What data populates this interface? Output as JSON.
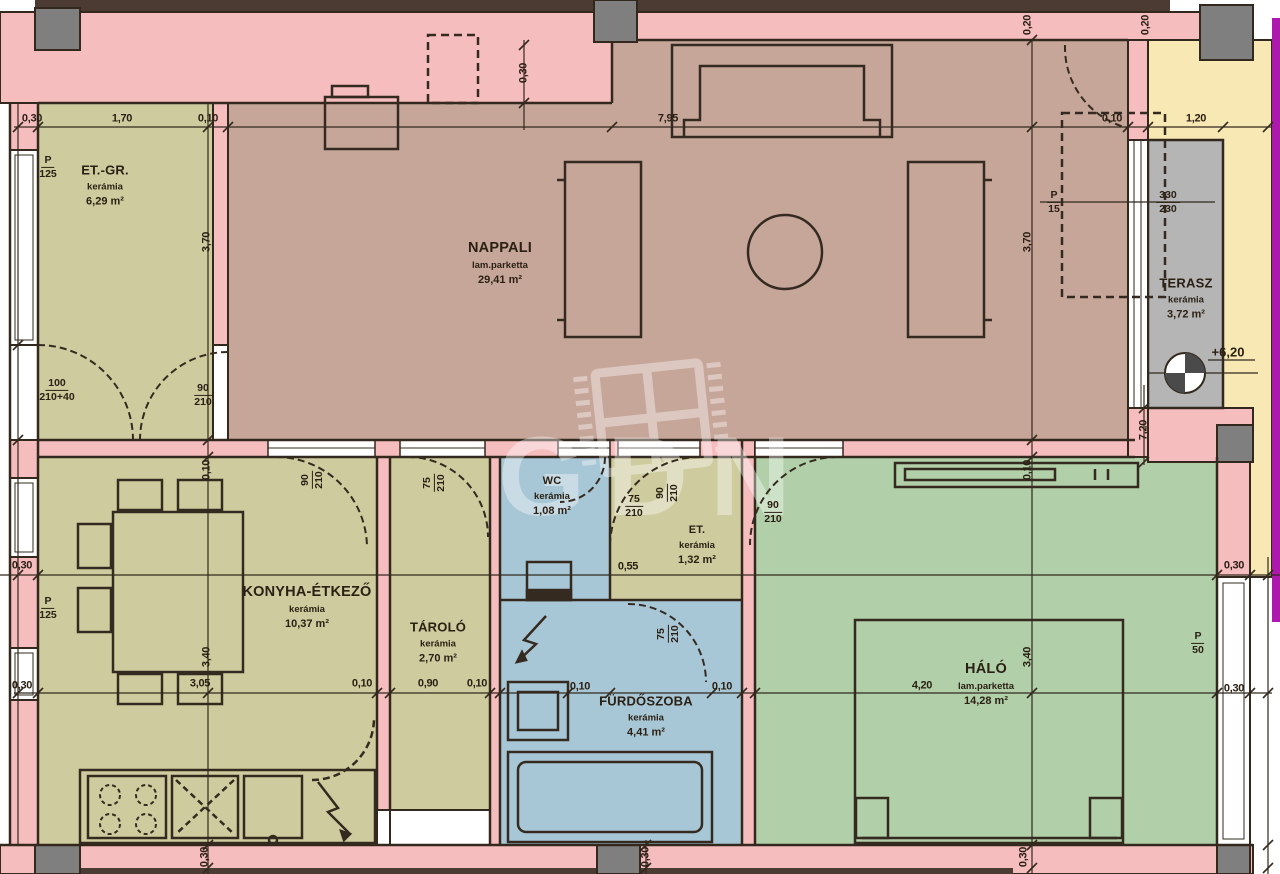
{
  "watermark": {
    "text": "GDN"
  },
  "palette": {
    "wall_pink": "#f6bdbf",
    "room_olive": "#cecc9e",
    "room_living": "#c7a69a",
    "room_blue": "#a8c7d6",
    "room_green": "#b1d0a9",
    "terrace_gray": "#b5b5b5",
    "surround_cream": "#f8e9b4",
    "pillar_gray": "#7f7f7f",
    "line_dark": "#2f261b",
    "edge_purple": "#ac19ac"
  },
  "rooms": [
    {
      "id": "et-gr",
      "name": "ET.-GR.",
      "material": "kerámia",
      "area": "6,29 m²"
    },
    {
      "id": "nappali",
      "name": "NAPPALI",
      "material": "lam.parketta",
      "area": "29,41 m²"
    },
    {
      "id": "terasz",
      "name": "TERASZ",
      "material": "kerámia",
      "area": "3,72 m²"
    },
    {
      "id": "konyha",
      "name": "KONYHA-ÉTKEZŐ",
      "material": "kerámia",
      "area": "10,37 m²"
    },
    {
      "id": "tarolo",
      "name": "TÁROLÓ",
      "material": "kerámia",
      "area": "2,70 m²"
    },
    {
      "id": "wc",
      "name": "WC",
      "material": "kerámia",
      "area": "1,08 m²"
    },
    {
      "id": "et",
      "name": "ET.",
      "material": "kerámia",
      "area": "1,32 m²"
    },
    {
      "id": "furdoszoba",
      "name": "FÜRDŐSZOBA",
      "material": "kerámia",
      "area": "4,41 m²"
    },
    {
      "id": "halo",
      "name": "HÁLÓ",
      "material": "lam.parketta",
      "area": "14,28 m²"
    }
  ],
  "elevation_label": "+6,20",
  "dim_labels": [
    {
      "text": "0,30",
      "x": 32,
      "y": 119
    },
    {
      "text": "1,70",
      "x": 122,
      "y": 119
    },
    {
      "text": "0,10",
      "x": 208,
      "y": 119
    },
    {
      "text": "7,95",
      "x": 668,
      "y": 119
    },
    {
      "text": "0,10",
      "x": 1112,
      "y": 119
    },
    {
      "text": "1,20",
      "x": 1196,
      "y": 119
    },
    {
      "text": "0,30",
      "x": 524,
      "y": 73,
      "rot": true
    },
    {
      "text": "0,20",
      "x": 1028,
      "y": 25,
      "rot": true
    },
    {
      "text": "0,20",
      "x": 1146,
      "y": 25,
      "rot": true
    },
    {
      "text": "3,70",
      "x": 207,
      "y": 242,
      "rot": true
    },
    {
      "text": "0,10",
      "x": 207,
      "y": 470,
      "rot": true
    },
    {
      "text": "3,40",
      "x": 207,
      "y": 657,
      "rot": true
    },
    {
      "text": "0,30",
      "x": 205,
      "y": 857,
      "rot": true
    },
    {
      "text": "3,70",
      "x": 1028,
      "y": 242,
      "rot": true
    },
    {
      "text": "0,10",
      "x": 1028,
      "y": 470,
      "rot": true
    },
    {
      "text": "3,40",
      "x": 1028,
      "y": 657,
      "rot": true
    },
    {
      "text": "0,30",
      "x": 1024,
      "y": 857,
      "rot": true
    },
    {
      "text": "0,30",
      "x": 646,
      "y": 857,
      "rot": true
    },
    {
      "text": "7,20",
      "x": 1144,
      "y": 430,
      "rot": true
    },
    {
      "text": "0,30",
      "x": 22,
      "y": 566
    },
    {
      "text": "0,30",
      "x": 1234,
      "y": 566
    },
    {
      "text": "0,30",
      "x": 22,
      "y": 686
    },
    {
      "text": "3,05",
      "x": 200,
      "y": 684
    },
    {
      "text": "0,10",
      "x": 362,
      "y": 684
    },
    {
      "text": "0,90",
      "x": 428,
      "y": 684
    },
    {
      "text": "0,10",
      "x": 477,
      "y": 684
    },
    {
      "text": "0,10",
      "x": 580,
      "y": 687
    },
    {
      "text": "0,10",
      "x": 722,
      "y": 687
    },
    {
      "text": "4,20",
      "x": 922,
      "y": 686
    },
    {
      "text": "0,30",
      "x": 1234,
      "y": 689
    },
    {
      "text": "0,55",
      "x": 628,
      "y": 567
    }
  ],
  "fractions": [
    {
      "top": "P",
      "bottom": "125",
      "x": 48,
      "y": 167
    },
    {
      "top": "P",
      "bottom": "125",
      "x": 48,
      "y": 608
    },
    {
      "top": "P",
      "bottom": "50",
      "x": 1198,
      "y": 643
    },
    {
      "top": "P",
      "bottom": "15",
      "x": 1054,
      "y": 202
    },
    {
      "top": "330",
      "bottom": "230",
      "x": 1168,
      "y": 202
    },
    {
      "top": "100",
      "bottom": "210+40",
      "x": 57,
      "y": 390
    },
    {
      "top": "90",
      "bottom": "210",
      "x": 203,
      "y": 395
    },
    {
      "top": "90",
      "bottom": "210",
      "x": 312,
      "y": 480,
      "rot": true
    },
    {
      "top": "75",
      "bottom": "210",
      "x": 434,
      "y": 483,
      "rot": true
    },
    {
      "top": "75",
      "bottom": "210",
      "x": 634,
      "y": 506
    },
    {
      "top": "90",
      "bottom": "210",
      "x": 667,
      "y": 493,
      "rot": true
    },
    {
      "top": "90",
      "bottom": "210",
      "x": 773,
      "y": 512
    },
    {
      "top": "75",
      "bottom": "210",
      "x": 668,
      "y": 634,
      "rot": true
    }
  ]
}
